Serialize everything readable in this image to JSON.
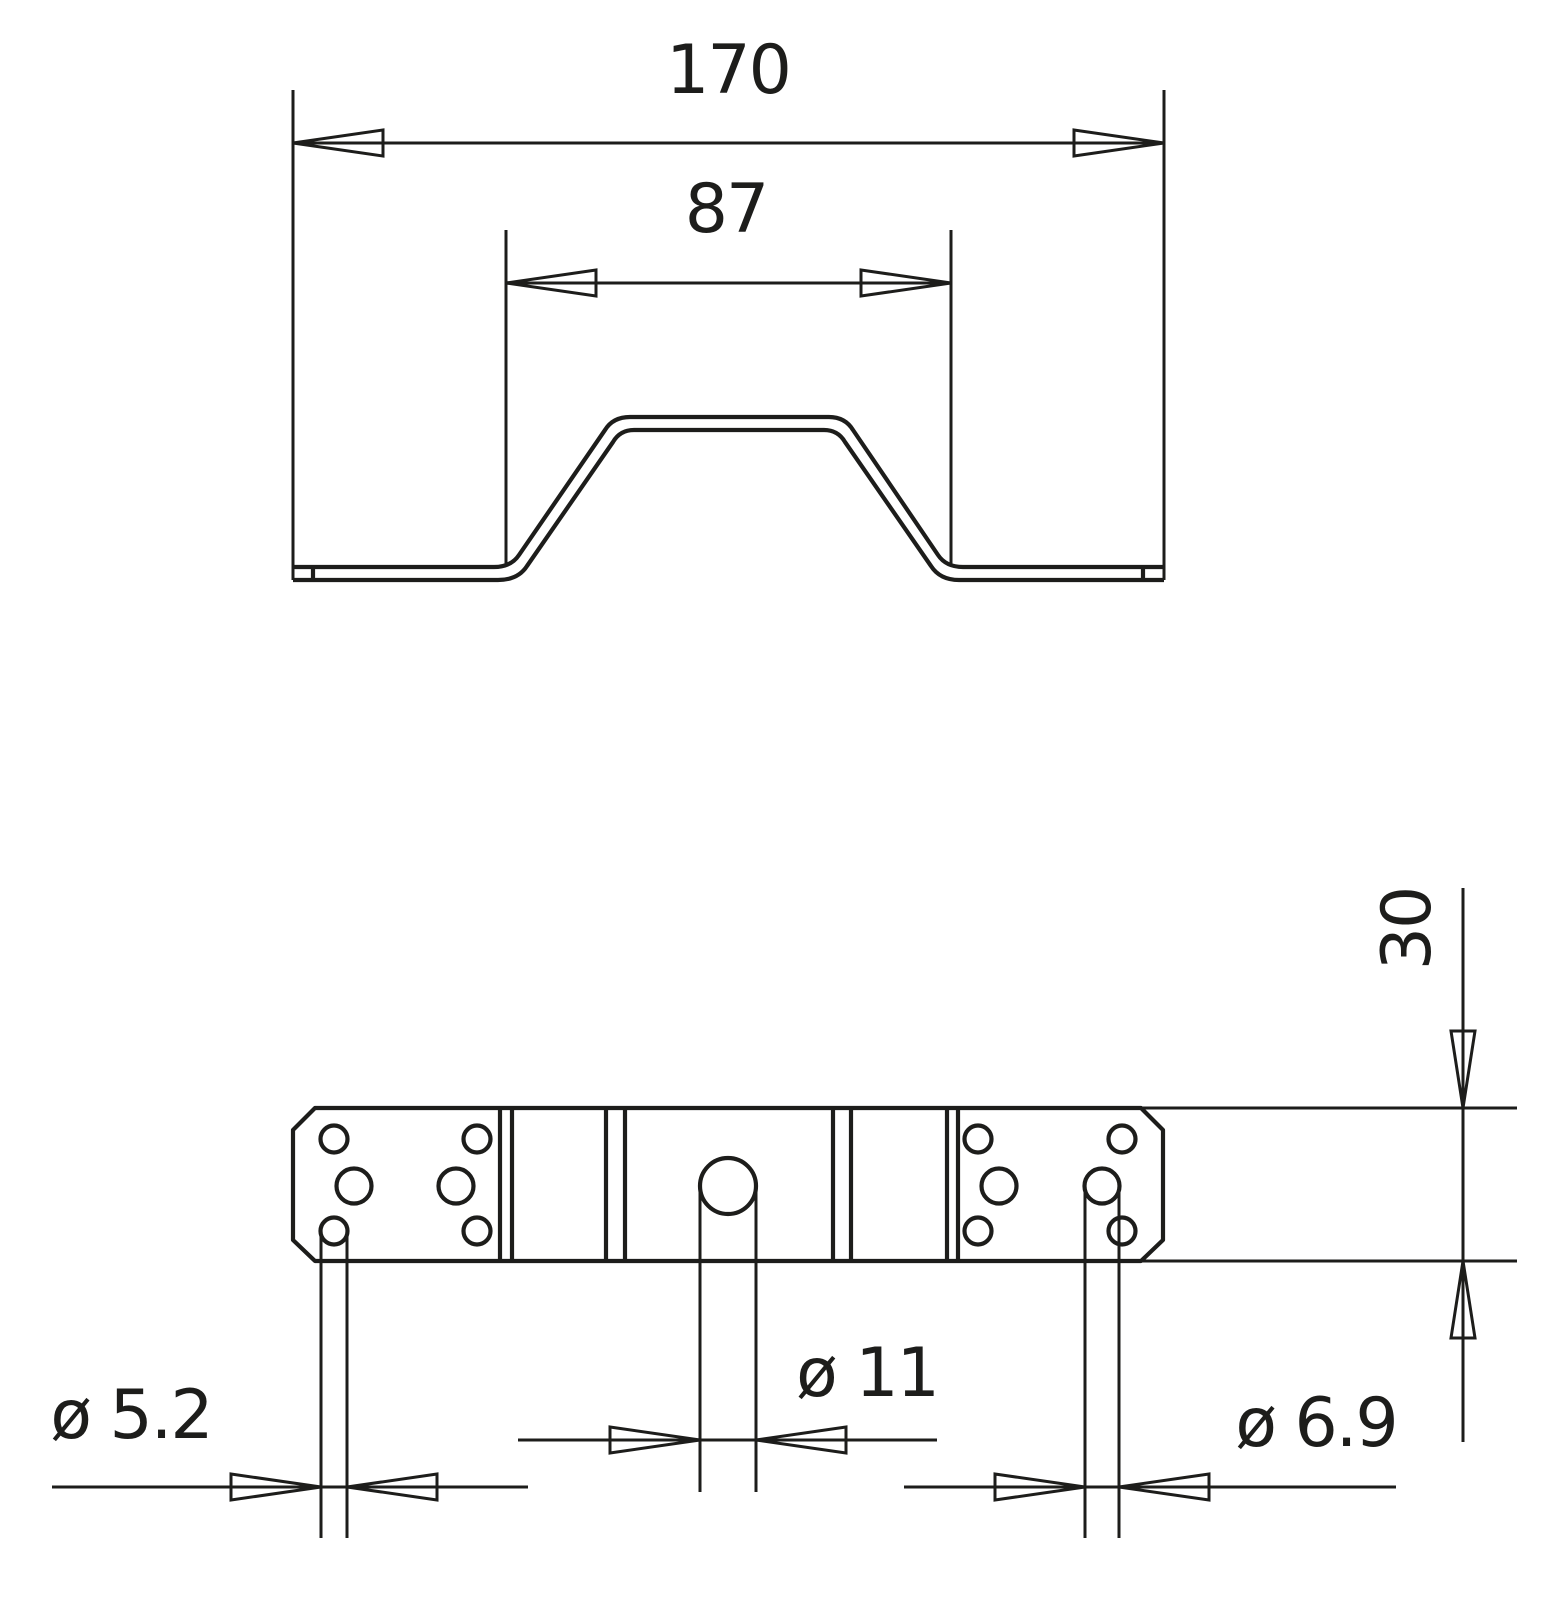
{
  "drawing": {
    "type": "engineering-drawing",
    "style": {
      "line_color": "#1d1d1b",
      "background_color": "#ffffff"
    },
    "front_view": {
      "dim_overall_width": "170",
      "dim_hump_width": "87"
    },
    "plan_view": {
      "dim_strip_width": "30",
      "dim_hole_small": "ø 5.2",
      "dim_hole_center": "ø 11",
      "dim_hole_medium": "ø 6.9"
    }
  }
}
